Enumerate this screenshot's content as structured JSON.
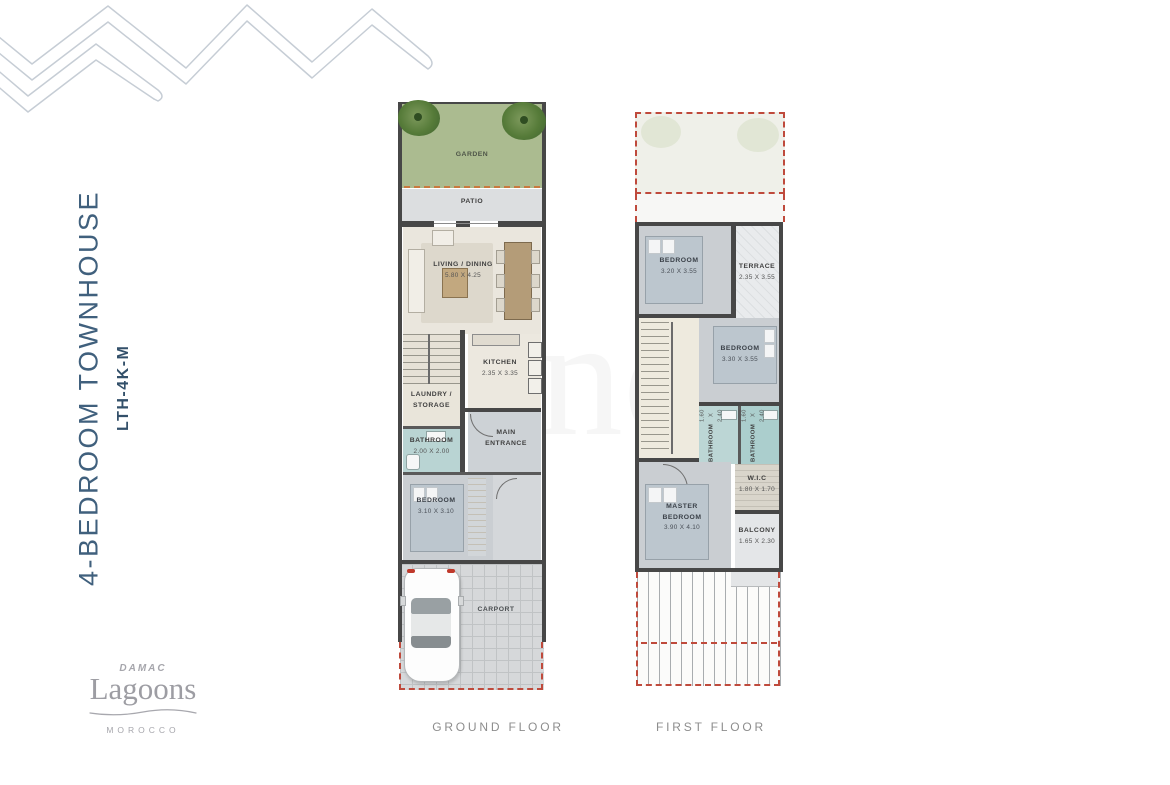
{
  "header": {
    "title": "4-BEDROOM TOWNHOUSE",
    "code": "LTH-4K-M"
  },
  "logo": {
    "brand": "DAMAC",
    "name": "Lagoons",
    "country": "MOROCCO"
  },
  "watermark": "no",
  "colors": {
    "title_blue": "#40607d",
    "wall_gray": "#474747",
    "accent_red_dashed": "#bf4a3c",
    "accent_orange_dashed": "#c8793f",
    "garden_green": "#abbb90",
    "bath_teal": "#b9d4d3"
  },
  "floors": {
    "ground": {
      "caption": "GROUND FLOOR",
      "rooms": {
        "garden": {
          "label": "GARDEN"
        },
        "patio": {
          "label": "PATIO"
        },
        "living": {
          "label": "LIVING / DINING",
          "dims": "5.80 X 4.25"
        },
        "kitchen": {
          "label": "KITCHEN",
          "dims": "2.35 X 3.35"
        },
        "laundry": {
          "label": "LAUNDRY / STORAGE"
        },
        "bathroom": {
          "label": "BATHROOM",
          "dims": "2.00 X 2.00"
        },
        "entrance": {
          "label": "MAIN ENTRANCE"
        },
        "bedroom": {
          "label": "BEDROOM",
          "dims": "3.10 X 3.10"
        },
        "carport": {
          "label": "CARPORT"
        }
      }
    },
    "first": {
      "caption": "FIRST FLOOR",
      "rooms": {
        "bedroom1": {
          "label": "BEDROOM",
          "dims": "3.20 X 3.55"
        },
        "terrace": {
          "label": "TERRACE",
          "dims": "2.35 X 3.55"
        },
        "bedroom2": {
          "label": "BEDROOM",
          "dims": "3.30 X 3.55"
        },
        "bathroom1": {
          "label": "BATHROOM",
          "dims": "1.60 X 2.40"
        },
        "bathroom2": {
          "label": "BATHROOM",
          "dims": "1.60 X 2.40"
        },
        "wic": {
          "label": "W.I.C",
          "dims": "1.80 X 1.70"
        },
        "master": {
          "label": "MASTER BEDROOM",
          "dims": "3.90 X 4.10"
        },
        "balcony": {
          "label": "BALCONY",
          "dims": "1.65 X 2.30"
        }
      }
    }
  }
}
